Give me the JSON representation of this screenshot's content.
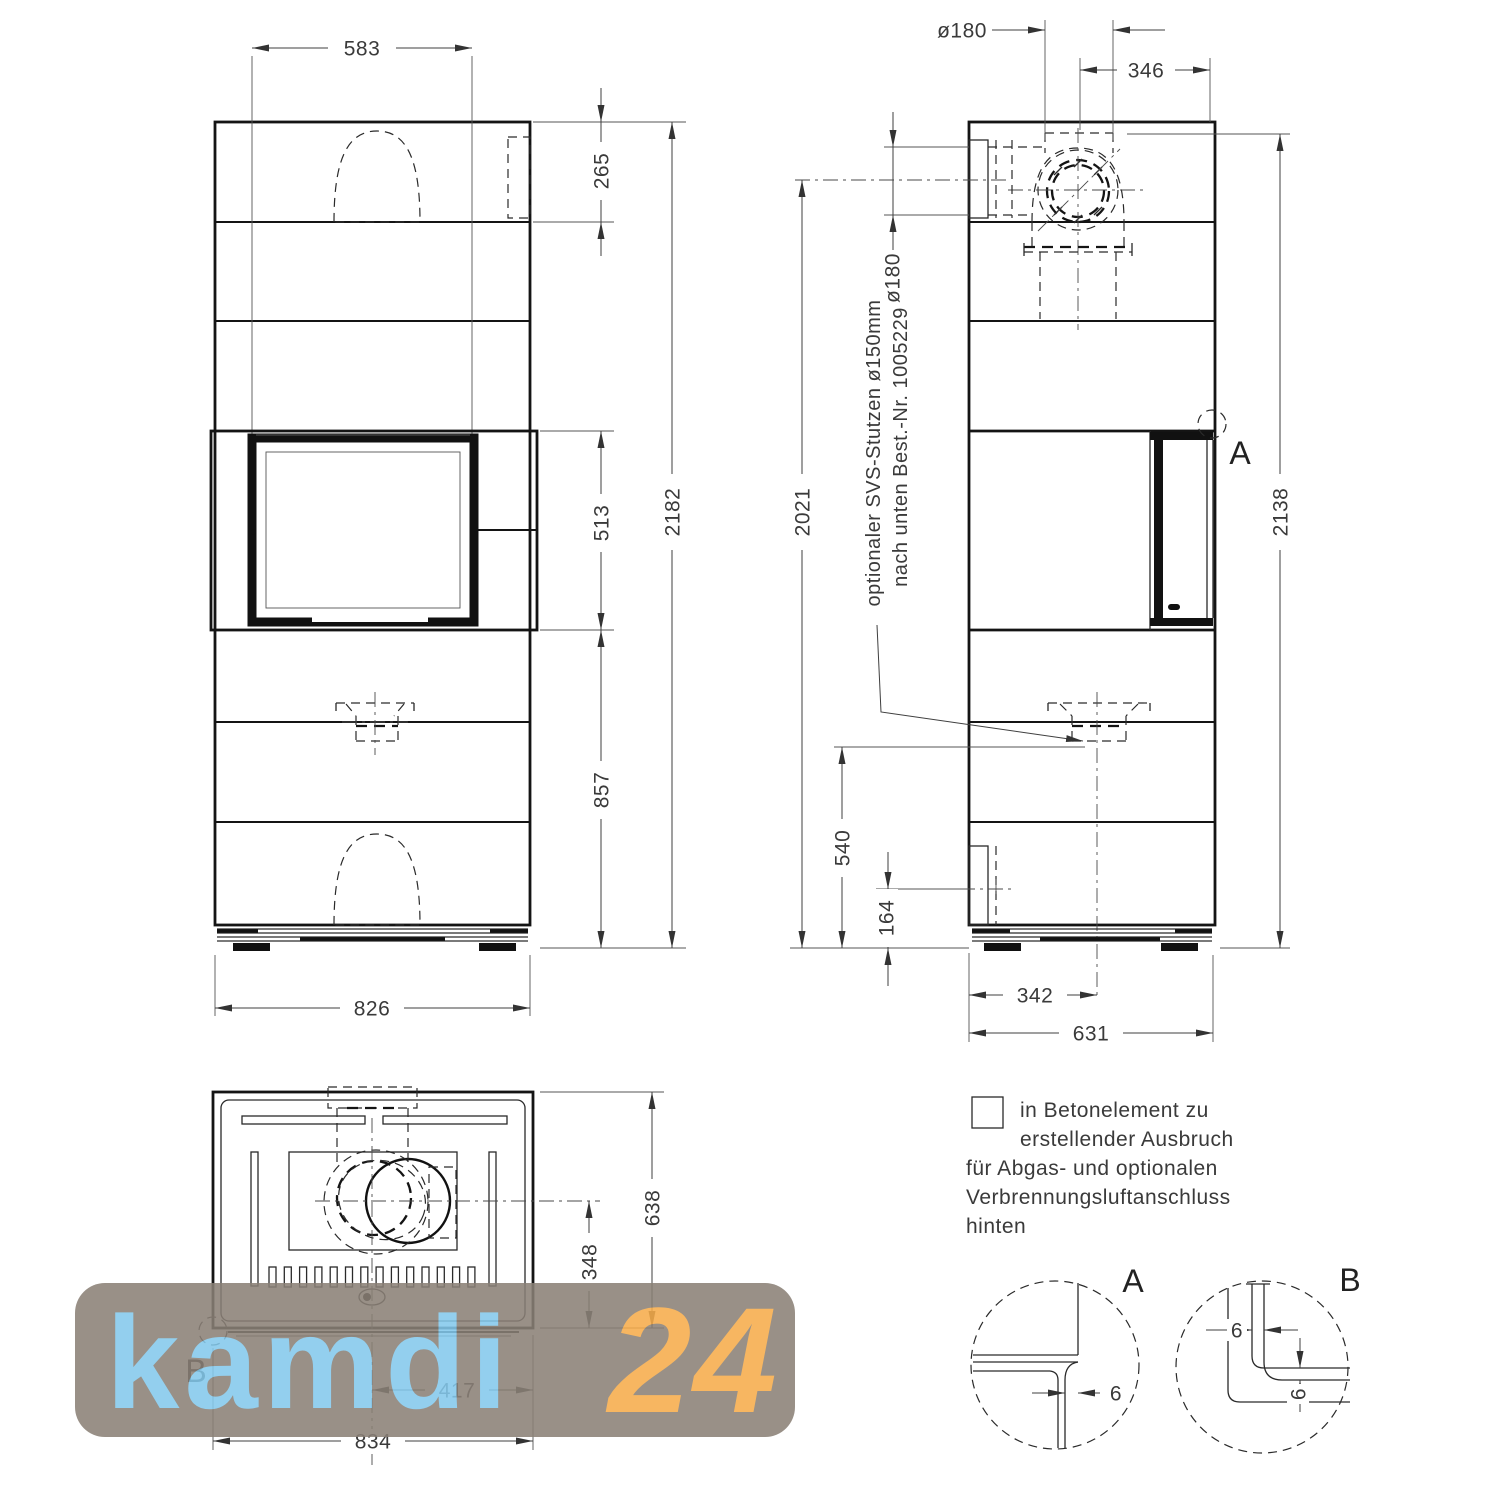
{
  "watermark": {
    "brand": "kamdi",
    "number": "24",
    "brand_color": "#84c9ec",
    "number_color": "#f6ac4a",
    "bg_color": "#8a8076"
  },
  "front_view": {
    "dims": {
      "insert_width": "583",
      "top_section_height": "265",
      "firebox_section_height": "513",
      "total_height": "2182",
      "lower_section_height": "857",
      "overall_width": "826"
    }
  },
  "side_view": {
    "dims": {
      "flue_diameter": "ø180",
      "flue_center_to_front": "346",
      "flue_center_height": "2021",
      "rear_outlet_diameter": "ø180",
      "overall_height": "2138",
      "air_connection_height": "540",
      "rear_opening_center_height": "164",
      "air_center_from_rear": "342",
      "overall_depth": "631"
    },
    "annotation": {
      "line1": "optionaler SVS-Stutzen ø150mm",
      "line2": "nach unten Best.-Nr. 1005229"
    },
    "detail_marker": "A"
  },
  "top_view": {
    "dims": {
      "overall_depth": "638",
      "center_to_front": "348",
      "center_to_side": "417",
      "overall_width": "834"
    },
    "detail_marker": "B"
  },
  "legend": {
    "lines": [
      "in Betonelement zu",
      "erstellender Ausbruch",
      "für Abgas- und optionalen",
      "Verbrennungsluftanschluss",
      "hinten"
    ]
  },
  "details": {
    "a": {
      "label": "A",
      "gap": "6"
    },
    "b": {
      "label": "B",
      "gap_horizontal": "6",
      "gap_vertical": "6"
    }
  }
}
